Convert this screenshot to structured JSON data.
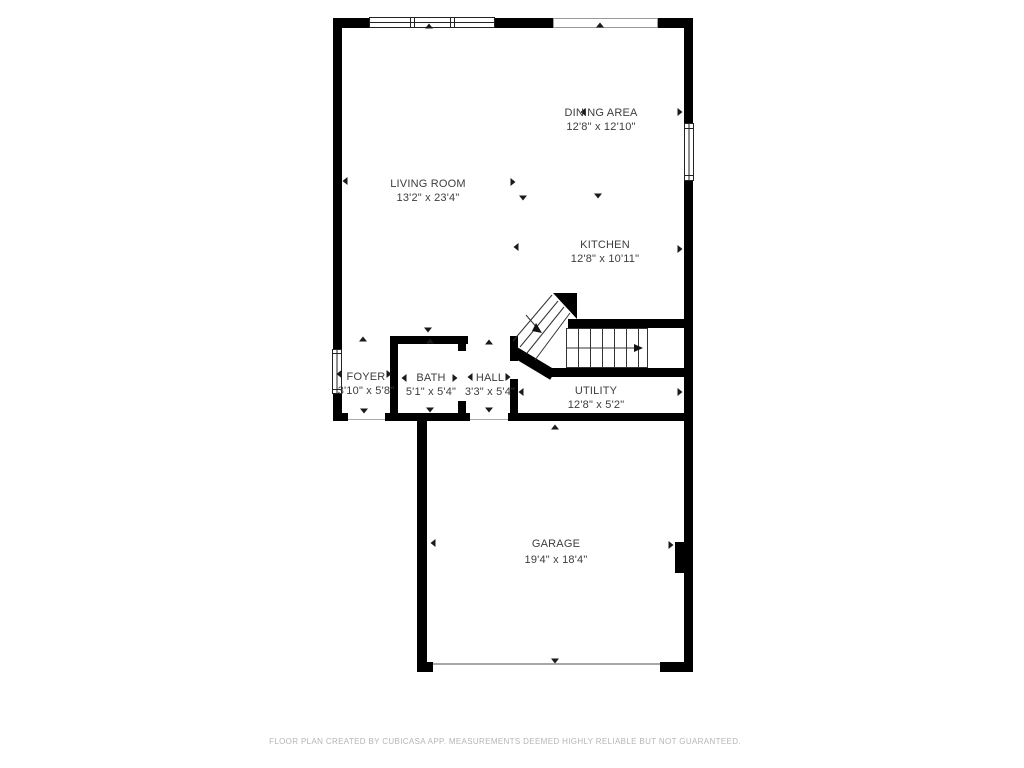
{
  "floor_plan": {
    "wall_color": "#000000",
    "text_color": "#3d3d3d",
    "footer_color": "#b5b5b5",
    "rooms": [
      {
        "id": "living-room",
        "name": "LIVING ROOM",
        "dimensions": "13'2\" x 23'4\""
      },
      {
        "id": "dining-area",
        "name": "DINING AREA",
        "dimensions": "12'8\" x 12'10\""
      },
      {
        "id": "kitchen",
        "name": "KITCHEN",
        "dimensions": "12'8\" x 10'11\""
      },
      {
        "id": "foyer",
        "name": "FOYER",
        "dimensions": "3'10\" x 5'8\""
      },
      {
        "id": "bath",
        "name": "BATH",
        "dimensions": "5'1\" x 5'4\""
      },
      {
        "id": "hall",
        "name": "HALL",
        "dimensions": "3'3\" x 5'4\""
      },
      {
        "id": "utility",
        "name": "UTILITY",
        "dimensions": "12'8\" x 5'2\""
      },
      {
        "id": "garage",
        "name": "GARAGE",
        "dimensions": "19'4\" x 18'4\""
      }
    ],
    "footer": {
      "text": "FLOOR PLAN CREATED BY CUBICASA APP. MEASUREMENTS DEEMED HIGHLY RELIABLE BUT NOT GUARANTEED."
    }
  }
}
